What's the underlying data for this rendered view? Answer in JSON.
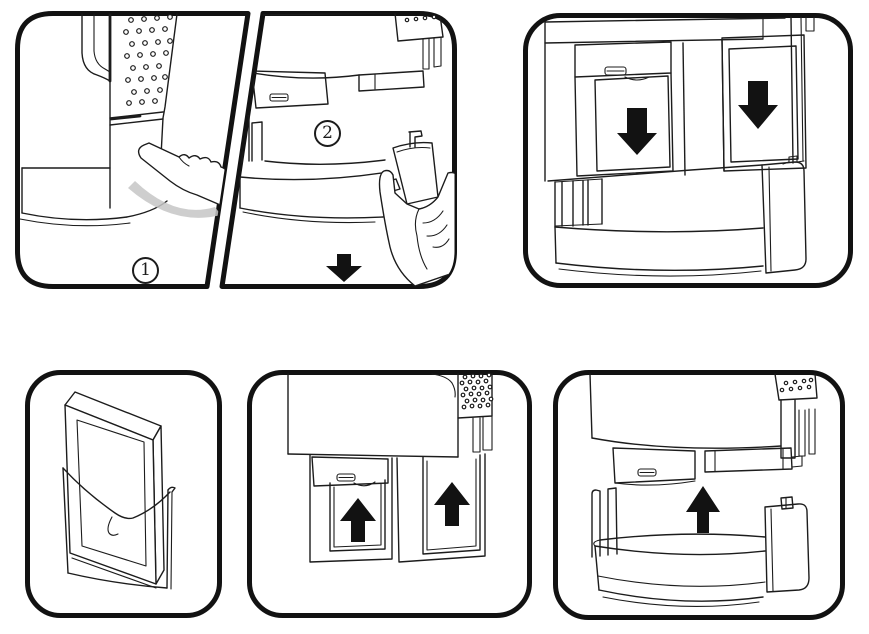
{
  "colors": {
    "ink": "#1c1c1c",
    "paper": "#ffffff",
    "shade": "#c6c6c6",
    "border": "#121212"
  },
  "labels": {
    "step_one": "1",
    "step_two": "2"
  }
}
